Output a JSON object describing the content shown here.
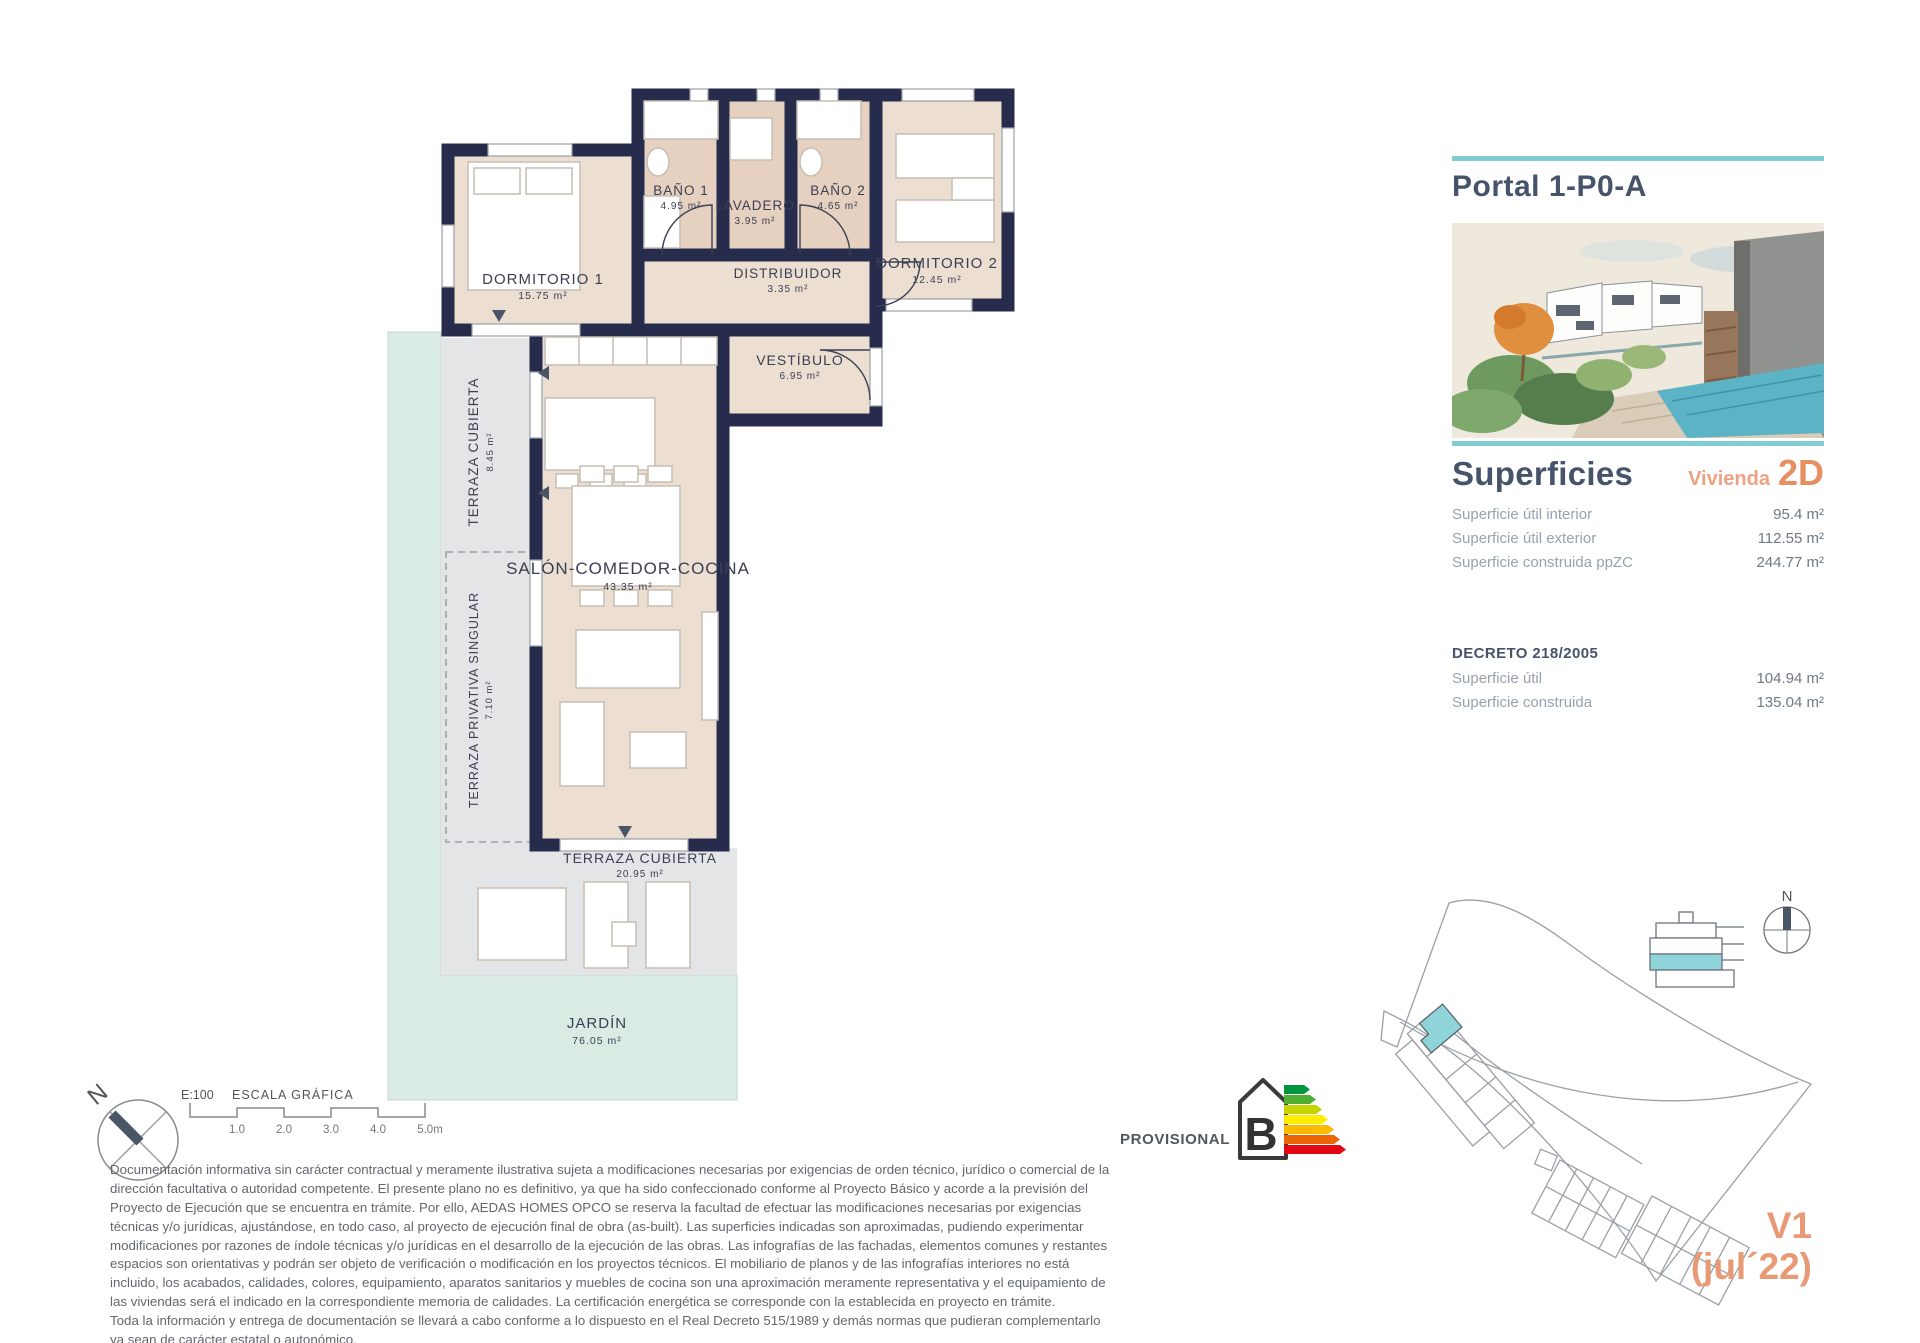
{
  "header": {
    "title": "Portal 1-P0-A"
  },
  "superficies": {
    "title": "Superficies",
    "vivienda_label": "Vivienda",
    "vivienda_value": "2D",
    "rows": [
      {
        "label": "Superficie útil interior",
        "value": "95.4 m²"
      },
      {
        "label": "Superficie útil exterior",
        "value": "112.55 m²"
      },
      {
        "label": "Superficie construida ppZC",
        "value": "244.77 m²"
      }
    ]
  },
  "decreto": {
    "title": "DECRETO 218/2005",
    "rows": [
      {
        "label": "Superficie útil",
        "value": "104.94 m²"
      },
      {
        "label": "Superficie construida",
        "value": "135.04 m²"
      }
    ]
  },
  "floorplan": {
    "rooms": [
      {
        "name": "DORMITORIO 1",
        "area": "15.75 m²"
      },
      {
        "name": "BAÑO 1",
        "area": "4.95 m²"
      },
      {
        "name": "LAVADERO",
        "area": "3.95 m²"
      },
      {
        "name": "BAÑO 2",
        "area": "4.65 m²"
      },
      {
        "name": "DORMITORIO 2",
        "area": "12.45 m²"
      },
      {
        "name": "DISTRIBUIDOR",
        "area": "3.35 m²"
      },
      {
        "name": "VESTÍBULO",
        "area": "6.95 m²"
      },
      {
        "name": "SALÓN-COMEDOR-COCINA",
        "area": "43.35 m²"
      },
      {
        "name": "TERRAZA CUBIERTA",
        "area": "8.45 m²"
      },
      {
        "name": "TERRAZA PRIVATIVA SINGULAR",
        "area": "7.10 m²"
      },
      {
        "name": "TERRAZA CUBIERTA",
        "area": "20.95 m²"
      },
      {
        "name": "JARDÍN",
        "area": "76.05 m²"
      }
    ]
  },
  "scalebar": {
    "scale": "E:100",
    "label": "ESCALA GRÁFICA",
    "ticks": [
      "1.0",
      "2.0",
      "3.0",
      "4.0",
      "5.0m"
    ]
  },
  "energy": {
    "provisional": "PROVISIONAL",
    "letter": "B"
  },
  "version": {
    "line1": "V1",
    "line2": "(jul´22)"
  },
  "plan_compass": {
    "north": "N"
  },
  "site_compass": {
    "north": "N"
  },
  "disclaimer": {
    "para1": "Documentación informativa sin carácter contractual y meramente ilustrativa sujeta a modificaciones necesarias por exigencias de orden técnico, jurídico o comercial de la dirección facultativa o autoridad competente. El presente plano no es definitivo, ya que ha sido confeccionado conforme al Proyecto Básico y acorde a la previsión del Proyecto de Ejecución que se encuentra en trámite. Por ello, AEDAS HOMES OPCO se reserva la facultad de efectuar las modificaciones necesarias por exigencias técnicas y/o jurídicas, ajustándose, en todo caso, al proyecto de ejecución final de obra (as-built). Las superficies indicadas son aproximadas, pudiendo experimentar modificaciones por razones de índole técnicas y/o jurídicas en el desarrollo de la ejecución de las obras. Las infografías de las fachadas, elementos comunes y restantes espacios son orientativas y podrán ser objeto de verificación o modificación en los proyectos técnicos. El mobiliario de planos y de las infografías interiores no está incluido, los acabados, calidades, colores, equipamiento, aparatos sanitarios y muebles de cocina son una aproximación meramente representativa y el equipamiento de las viviendas será el indicado en la correspondiente memoria de calidades. La certificación energética se corresponde con la establecida en proyecto en trámite.",
    "para2": "Toda la información y entrega de documentación se llevará a cabo conforme a lo dispuesto en el Real Decreto 515/1989 y demás normas que pudieran complementarlo ya sean de carácter estatal o autonómico."
  },
  "colors": {
    "teal_accent": "#7fccd1",
    "wall_navy": "#272c4d",
    "orange": "#e89a76",
    "slate": "#46536b",
    "floor_beige": "#ecdfd2",
    "bath_tan": "#e6d0bf",
    "terrace_gray": "#e4e5e7",
    "garden_mint": "#d9ebe3"
  }
}
